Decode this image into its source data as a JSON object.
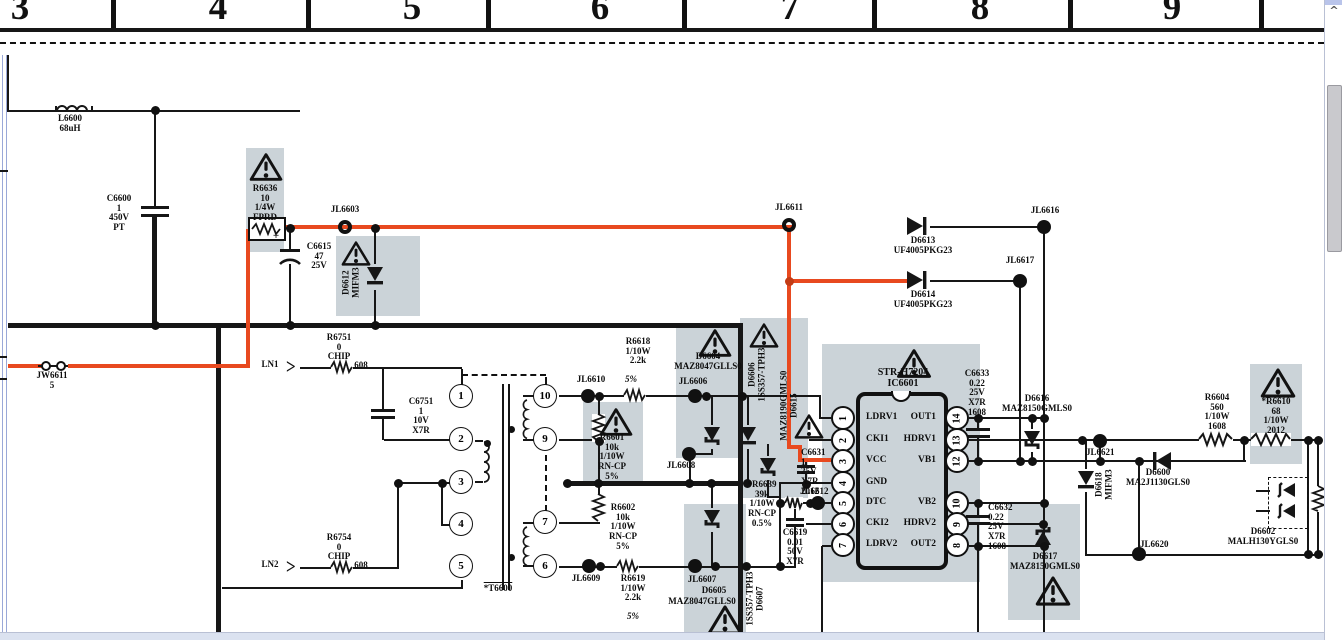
{
  "ruler": {
    "zones": [
      "3",
      "4",
      "5",
      "6",
      "7",
      "8",
      "9"
    ]
  },
  "colors": {
    "wire_highlight_red": "#e8491f",
    "component_panel_gray": "#cbd3d8"
  },
  "scrollbar": {
    "up_arrow": "^"
  },
  "transformer": {
    "label": "*T6600",
    "left_pins": [
      "1",
      "2",
      "3",
      "4",
      "5"
    ],
    "right_pins": [
      "10",
      "9",
      "7",
      "6"
    ]
  },
  "ic6601": {
    "title": "STR-H7204\nIC6601",
    "left_pins": [
      {
        "num": "1",
        "label": "LDRV1"
      },
      {
        "num": "2",
        "label": "CKI1"
      },
      {
        "num": "3",
        "label": "VCC"
      },
      {
        "num": "4",
        "label": "GND"
      },
      {
        "num": "5",
        "label": "DTC"
      },
      {
        "num": "6",
        "label": "CKI2"
      },
      {
        "num": "7",
        "label": "LDRV2"
      }
    ],
    "right_pins": [
      {
        "num": "14",
        "label": "OUT1"
      },
      {
        "num": "13",
        "label": "HDRV1"
      },
      {
        "num": "12",
        "label": "VB1"
      },
      {
        "num": "10",
        "label": "VB2"
      },
      {
        "num": "9",
        "label": "HDRV2"
      },
      {
        "num": "8",
        "label": "OUT2"
      }
    ]
  },
  "labels": {
    "l6600": "L6600\n68uH",
    "c6600": "C6600\n1\n450V\nPT",
    "r6636": "R6636\n10\n1/4W\nFPRD",
    "jl6603": "JL6603",
    "c6615": "C6615\n47\n25V",
    "c6615_plus": "+",
    "d6612": "D6612\nMIFM3",
    "jw6611": "JW6611\n5",
    "ln1": "LN1",
    "ln2": "LN2",
    "r6751": "R6751\n0\nCHIP",
    "r6751_size": "608",
    "r6754": "R6754\n0\nCHIP",
    "r6754_size": "608",
    "c6751": "C6751\n1\n10V\nX7R",
    "t6600": "*T6600",
    "jl6611": "JL6611",
    "d6613": "D6613\nUF4005PKG23",
    "d6614": "D6614\nUF4005PKG23",
    "jl6616": "JL6616",
    "jl6617": "JL6617",
    "jl6610": "JL6610",
    "r6618_tol": "5%",
    "r6618": "R6618\n1/10W\n2.2k",
    "r6601": "R6601\n10k\n1/10W\nRN-CP\n5%",
    "jl6606": "JL6606",
    "d6604": "D6604\nMAZ8047GLLS0",
    "d6606": "D6606\n1SS357-TPH3",
    "d6615": "MAZ8190GMLS0\nD6615",
    "jl6608": "JL6608",
    "c6631": "C6631\n1\n25V\nX7R\n2012",
    "jl6612": "JL6612",
    "r6639": "*R6639\n39k\n1/10W\nRN-CP\n0.5%",
    "c6619": "C6619\n0.01\n50V\nX7R",
    "r6602": "R6602\n10k\n1/10W\nRN-CP\n5%",
    "jl6609": "JL6609",
    "r6619": "R6619\n1/10W\n2.2k",
    "r6619_tol": "5%",
    "jl6607": "JL6607",
    "d6605": "D6605",
    "d6605_part": "MAZ8047GLLS0",
    "d6607": "1SS357-TPH3\nD6607",
    "c6633": "C6633\n0.22\n25V\nX7R\n1608",
    "d6616": "D6616\nMAZ8150GMLS0",
    "c6632": "C6632\n0.22\n25V\nX7R\n1608",
    "d6617": "D6617\nMAZ8150GMLS0",
    "jl6621": "JL6621",
    "d6618": "D6618\nMIFM3",
    "jl6620": "JL6620",
    "d6600": "D6600\nMA2J1130GLS0",
    "r6604": "R6604\n560\n1/10W\n1608",
    "r6610": "*R6610\n68\n1/10W\n2012",
    "d6602": "D6602\nMALH130YGLS0"
  }
}
